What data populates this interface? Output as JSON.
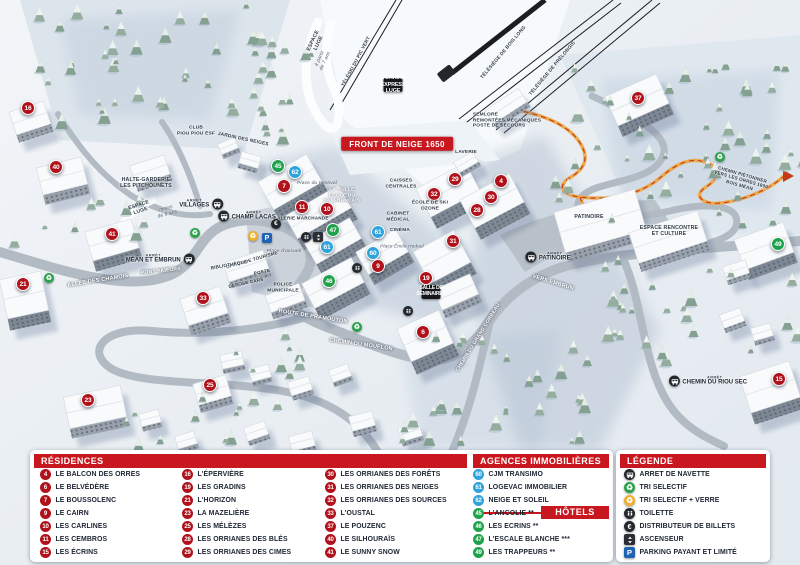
{
  "map": {
    "marker_colors": {
      "residence": "#b0111a",
      "hotel": "#1fa14b",
      "agence": "#2fa3db"
    },
    "markers": [
      {
        "n": "16",
        "type": "residence",
        "x": 28,
        "y": 108
      },
      {
        "n": "40",
        "type": "residence",
        "x": 56,
        "y": 167
      },
      {
        "n": "41",
        "type": "residence",
        "x": 112,
        "y": 234
      },
      {
        "n": "21",
        "type": "residence",
        "x": 23,
        "y": 284
      },
      {
        "n": "33",
        "type": "residence",
        "x": 203,
        "y": 298
      },
      {
        "n": "23",
        "type": "residence",
        "x": 88,
        "y": 400
      },
      {
        "n": "25",
        "type": "residence",
        "x": 210,
        "y": 385
      },
      {
        "n": "45",
        "type": "hotel",
        "x": 278,
        "y": 166
      },
      {
        "n": "62",
        "type": "agence",
        "x": 295,
        "y": 172
      },
      {
        "n": "7",
        "type": "residence",
        "x": 284,
        "y": 186
      },
      {
        "n": "11",
        "type": "residence",
        "x": 302,
        "y": 207
      },
      {
        "n": "10",
        "type": "residence",
        "x": 327,
        "y": 209
      },
      {
        "n": "47",
        "type": "hotel",
        "x": 333,
        "y": 230
      },
      {
        "n": "61",
        "type": "agence",
        "x": 327,
        "y": 247
      },
      {
        "n": "61",
        "type": "agence",
        "x": 378,
        "y": 232
      },
      {
        "n": "60",
        "type": "agence",
        "x": 373,
        "y": 253
      },
      {
        "n": "9",
        "type": "residence",
        "x": 378,
        "y": 266
      },
      {
        "n": "46",
        "type": "hotel",
        "x": 329,
        "y": 281
      },
      {
        "n": "32",
        "type": "residence",
        "x": 434,
        "y": 194
      },
      {
        "n": "29",
        "type": "residence",
        "x": 455,
        "y": 179
      },
      {
        "n": "4",
        "type": "residence",
        "x": 501,
        "y": 181
      },
      {
        "n": "30",
        "type": "residence",
        "x": 491,
        "y": 197
      },
      {
        "n": "28",
        "type": "residence",
        "x": 477,
        "y": 210
      },
      {
        "n": "31",
        "type": "residence",
        "x": 453,
        "y": 241
      },
      {
        "n": "19",
        "type": "residence",
        "x": 426,
        "y": 278
      },
      {
        "n": "6",
        "type": "residence",
        "x": 423,
        "y": 332
      },
      {
        "n": "37",
        "type": "residence",
        "x": 638,
        "y": 98
      },
      {
        "n": "49",
        "type": "hotel",
        "x": 778,
        "y": 244
      },
      {
        "n": "15",
        "type": "residence",
        "x": 779,
        "y": 379
      }
    ],
    "labels": [
      {
        "text": "FRONT DE NEIGE 1650",
        "x": 397,
        "y": 144,
        "rot": 0,
        "style": "banner",
        "size": 8
      },
      {
        "text": "L'ORRIAN EXPRESS\nLUGE",
        "x": 393,
        "y": 85,
        "rot": 0,
        "style": "badge",
        "size": 5.5
      },
      {
        "text": "ESPACE\nLUGE",
        "x": 316,
        "y": 42,
        "rot": -65,
        "style": "dark",
        "size": 5.2
      },
      {
        "text": "à partir\nde 7 ans",
        "x": 323,
        "y": 60,
        "rot": -65,
        "style": "italic",
        "size": 4.8
      },
      {
        "text": "TÉLÉSKI DU PIC VERT",
        "x": 357,
        "y": 62,
        "rot": -62,
        "style": "dark",
        "size": 4.8
      },
      {
        "text": "TÉLÉSIÈGE DE BOIS LONG",
        "x": 504,
        "y": 53,
        "rot": -50,
        "style": "dark",
        "size": 4.8
      },
      {
        "text": "TÉLÉSIÈGE DE PRÉLONGIS",
        "x": 553,
        "y": 69,
        "rot": -50,
        "style": "dark",
        "size": 4.8
      },
      {
        "text": "SEMLORE\nREMONTÉES MÉCANIQUES\nPOSTE DE SECOURS",
        "x": 507,
        "y": 121,
        "rot": 0,
        "style": "darkleft",
        "size": 4.8
      },
      {
        "text": "CLUB\nPIOU PIOU ESF",
        "x": 196,
        "y": 131,
        "rot": 0,
        "style": "dark",
        "size": 4.8
      },
      {
        "text": "JARDIN DES NEIGES",
        "x": 243,
        "y": 140,
        "rot": 12,
        "style": "dark",
        "size": 4.8
      },
      {
        "text": "HALTE-GARDERIE\nLES PITCHOUNETS",
        "x": 146,
        "y": 183,
        "rot": 0,
        "style": "dark",
        "size": 5.2
      },
      {
        "text": "ESPACE\nLUGE",
        "x": 140,
        "y": 209,
        "rot": -18,
        "style": "dark",
        "size": 5
      },
      {
        "text": "moins\nde 6 ans",
        "x": 167,
        "y": 212,
        "rot": -14,
        "style": "italic",
        "size": 4.8
      },
      {
        "text": "LAVERIE",
        "x": 466,
        "y": 153,
        "rot": 0,
        "style": "dark",
        "size": 4.8
      },
      {
        "text": "CAISSES\nCENTRALES",
        "x": 401,
        "y": 184,
        "rot": 0,
        "style": "dark",
        "size": 4.8
      },
      {
        "text": "LA BULLE\nÉCOLE DU\nSKI FRANÇAIS",
        "x": 342,
        "y": 196,
        "rot": 0,
        "style": "white",
        "size": 4.8
      },
      {
        "text": "Place du Festival",
        "x": 317,
        "y": 184,
        "rot": 0,
        "style": "italic",
        "size": 4.8
      },
      {
        "text": "GALERIE MARCHANDE",
        "x": 301,
        "y": 218,
        "rot": 0,
        "style": "dark",
        "size": 4.6
      },
      {
        "text": "ÉCOLE DE SKI\nOZONE",
        "x": 430,
        "y": 206,
        "rot": 0,
        "style": "dark",
        "size": 4.8
      },
      {
        "text": "CABINET\nMÉDICAL",
        "x": 398,
        "y": 217,
        "rot": 0,
        "style": "dark",
        "size": 4.8
      },
      {
        "text": "CINÉMA",
        "x": 400,
        "y": 231,
        "rot": 0,
        "style": "dark",
        "size": 4.8
      },
      {
        "text": "Place Émile Hodoul",
        "x": 402,
        "y": 246,
        "rot": 0,
        "style": "italic",
        "size": 4.6
      },
      {
        "text": "Place d'accueil",
        "x": 284,
        "y": 252,
        "rot": 0,
        "style": "italic",
        "size": 4.8
      },
      {
        "text": "OFFICE DE TOURISME",
        "x": 252,
        "y": 260,
        "rot": -16,
        "style": "dark",
        "size": 4.6
      },
      {
        "text": "BIBLIOTHÈQUE",
        "x": 229,
        "y": 265,
        "rot": -10,
        "style": "dark",
        "size": 4.6
      },
      {
        "text": "POSTE",
        "x": 262,
        "y": 272,
        "rot": -12,
        "style": "dark",
        "size": 4.6
      },
      {
        "text": "DÉPOSE CARS",
        "x": 246,
        "y": 283,
        "rot": -12,
        "style": "dark",
        "size": 4.6
      },
      {
        "text": "POLICE\nMUNICIPALE",
        "x": 283,
        "y": 288,
        "rot": 0,
        "style": "dark",
        "size": 4.8
      },
      {
        "text": "PONT SKIEURS",
        "x": 161,
        "y": 272,
        "rot": -6,
        "style": "road",
        "size": 5
      },
      {
        "text": "ALLÉE DES CHAMOIS",
        "x": 98,
        "y": 281,
        "rot": -9,
        "style": "road",
        "size": 5.5
      },
      {
        "text": "ROUTE DE PRAMOUTON",
        "x": 313,
        "y": 317,
        "rot": 9,
        "style": "road",
        "size": 5.5
      },
      {
        "text": "CHEMIN DU MOUFLON",
        "x": 361,
        "y": 345,
        "rot": 8,
        "style": "road",
        "size": 5.5
      },
      {
        "text": "CHEMIN DU GRAND CORBEAU",
        "x": 479,
        "y": 338,
        "rot": -58,
        "style": "road",
        "size": 5
      },
      {
        "text": "VERS EMBRUN",
        "x": 553,
        "y": 283,
        "rot": 17,
        "style": "road",
        "size": 5.5
      },
      {
        "text": "SALLE DE\nSÉMINAIRES",
        "x": 431,
        "y": 292,
        "rot": 0,
        "style": "badge",
        "size": 5
      },
      {
        "text": "PATINOIRE",
        "x": 589,
        "y": 217,
        "rot": 0,
        "style": "dark",
        "size": 5.2
      },
      {
        "text": "ESPACE RENCONTRE\nET CULTURE",
        "x": 669,
        "y": 231,
        "rot": 0,
        "style": "dark",
        "size": 5.2
      },
      {
        "text": "CHEMIN PIÉTONNIER\nVERS LES ORRES 1800\nBOIS MÉAN",
        "x": 741,
        "y": 180,
        "rot": 16,
        "style": "dark",
        "size": 4.6
      }
    ],
    "bus_stops": [
      {
        "prefix": "ARRÊT",
        "name": "CHAMP LACAS",
        "x": 247,
        "y": 216,
        "icon_side": "left"
      },
      {
        "prefix": "ARRÊT",
        "name": "VILLAGES",
        "x": 201,
        "y": 204,
        "icon_side": "right"
      },
      {
        "prefix": "ARRÊT",
        "name": "MÉAN ET EMBRUN",
        "x": 160,
        "y": 259,
        "icon_side": "right"
      },
      {
        "prefix": "ARRÊT",
        "name": "PATINOIRE",
        "x": 548,
        "y": 257,
        "icon_side": "left"
      },
      {
        "prefix": "ARRÊT",
        "name": "CHEMIN DU RIOU SEC",
        "x": 708,
        "y": 381,
        "icon_side": "left"
      }
    ],
    "icons": [
      {
        "type": "euro-icon",
        "x": 276,
        "y": 224
      },
      {
        "type": "recycle-yellow-icon",
        "x": 253,
        "y": 236
      },
      {
        "type": "parking-icon",
        "x": 267,
        "y": 238
      },
      {
        "type": "toilet-icon",
        "x": 306,
        "y": 237
      },
      {
        "type": "elevator-icon",
        "x": 318,
        "y": 237
      },
      {
        "type": "toilet-icon",
        "x": 357,
        "y": 268
      },
      {
        "type": "toilet-icon",
        "x": 408,
        "y": 311
      },
      {
        "type": "recycle-green-icon",
        "x": 195,
        "y": 233
      },
      {
        "type": "recycle-green-icon",
        "x": 49,
        "y": 278
      },
      {
        "type": "recycle-green-icon",
        "x": 357,
        "y": 327
      },
      {
        "type": "recycle-green-icon",
        "x": 720,
        "y": 157
      }
    ]
  },
  "legend": {
    "header_color": "#c8171e",
    "residences": {
      "title": "RÉSIDENCES",
      "columns": [
        [
          {
            "n": "4",
            "label": "LE BALCON DES ORRES"
          },
          {
            "n": "6",
            "label": "LE BELVÉDÈRE"
          },
          {
            "n": "7",
            "label": "LE BOUSSOLENC"
          },
          {
            "n": "9",
            "label": "LE CAIRN"
          },
          {
            "n": "10",
            "label": "LES CARLINES"
          },
          {
            "n": "11",
            "label": "LES CEMBROS"
          },
          {
            "n": "15",
            "label": "LES ÉCRINS"
          }
        ],
        [
          {
            "n": "16",
            "label": "L'ÉPERVIÈRE"
          },
          {
            "n": "19",
            "label": "LES GRADINS"
          },
          {
            "n": "21",
            "label": "L'HORIZON"
          },
          {
            "n": "23",
            "label": "LA MAZELIÈRE"
          },
          {
            "n": "25",
            "label": "LES MÉLÈZES"
          },
          {
            "n": "28",
            "label": "LES ORRIANES DES BLÉS"
          },
          {
            "n": "29",
            "label": "LES ORRIANES DES CIMES"
          }
        ],
        [
          {
            "n": "30",
            "label": "LES ORRIANES DES FORÊTS"
          },
          {
            "n": "31",
            "label": "LES ORRIANES DES NEIGES"
          },
          {
            "n": "32",
            "label": "LES ORRIANES DES SOURCES"
          },
          {
            "n": "33",
            "label": "L'OUSTAL"
          },
          {
            "n": "37",
            "label": "LE POUZENC"
          },
          {
            "n": "40",
            "label": "LE SILHOURAÏS"
          },
          {
            "n": "41",
            "label": "LE SUNNY SNOW"
          }
        ]
      ]
    },
    "agences": {
      "title": "AGENCES IMMOBILIÈRES",
      "items": [
        {
          "n": "60",
          "label": "CJM TRANSIMO"
        },
        {
          "n": "61",
          "label": "LOGEVAC IMMOBILIER"
        },
        {
          "n": "62",
          "label": "NEIGE ET SOLEIL"
        }
      ]
    },
    "hotels": {
      "title": "HÔTELS",
      "items": [
        {
          "n": "45",
          "label": "L'ANCOLIE **"
        },
        {
          "n": "46",
          "label": "LES ECRINS **"
        },
        {
          "n": "47",
          "label": "L'ESCALE BLANCHE ***"
        },
        {
          "n": "49",
          "label": "LES TRAPPEURS **"
        }
      ]
    },
    "legende": {
      "title": "LÉGENDE",
      "items": [
        {
          "icon": "bus-icon",
          "label": "ARRET DE NAVETTE"
        },
        {
          "icon": "recycle-green-icon",
          "label": "TRI SELECTIF"
        },
        {
          "icon": "recycle-yellow-icon",
          "label": "TRI SELECTIF + VERRE"
        },
        {
          "icon": "toilet-icon",
          "label": "TOILETTE"
        },
        {
          "icon": "euro-icon",
          "label": "DISTRIBUTEUR DE BILLETS"
        },
        {
          "icon": "elevator-icon",
          "label": "ASCENSEUR"
        },
        {
          "icon": "parking-icon",
          "label": "PARKING PAYANT ET LIMITÉ"
        }
      ]
    }
  }
}
